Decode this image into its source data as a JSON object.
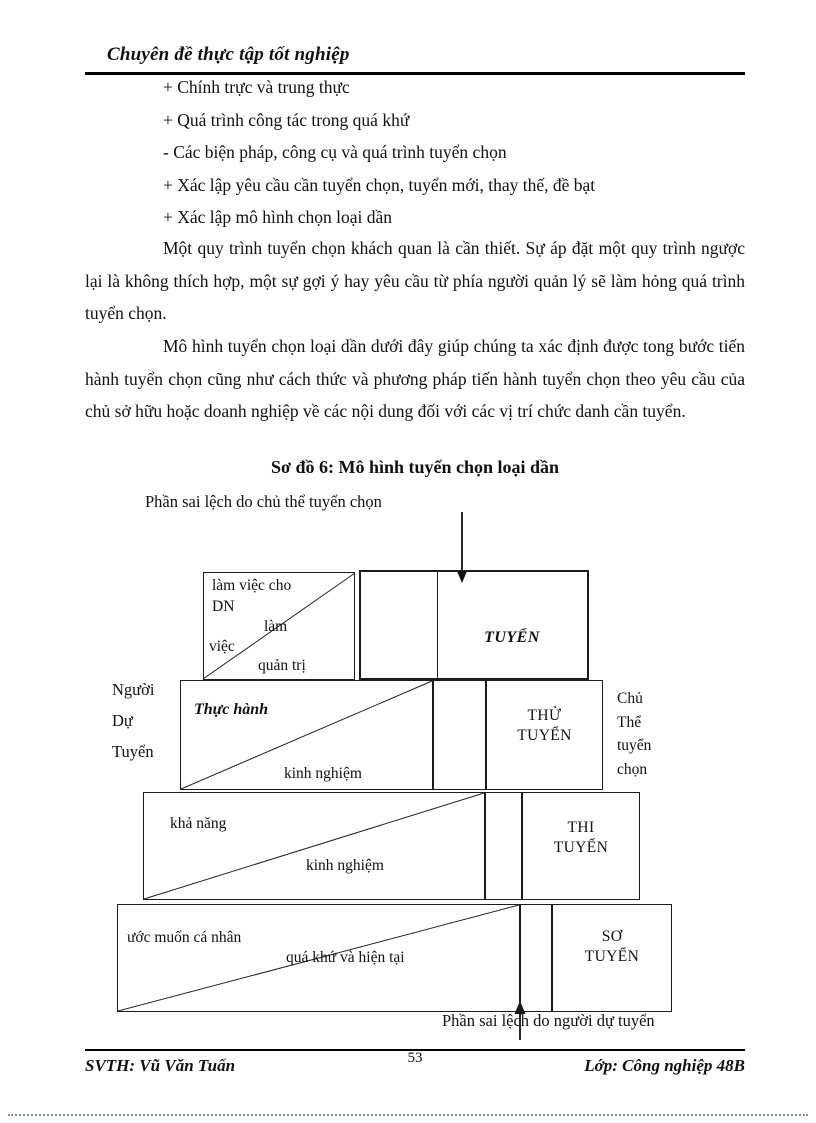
{
  "header": {
    "title": "Chuyên đề thực tập tốt nghiệp"
  },
  "bullets": [
    "+ Chính trực và trung thực",
    "+ Quá trình công tác trong quá khứ",
    "- Các biện pháp, công cụ và quá trình tuyển chọn",
    "+ Xác lập yêu cầu cần tuyển chọn, tuyển mới, thay thế, đề bạt",
    "+ Xác lập mô hình chọn loại dần"
  ],
  "paragraphs": [
    "Một quy trình tuyển chọn khách quan là cần thiết.  Sự áp đặt một quy trình ngược lại  là không thích hợp, một sự gợi ý hay yêu cầu từ phía người quản lý  sẽ làm hỏng quá trình tuyển chọn.",
    "Mô hình tuyển chọn loại dần dưới đây giúp  chúng ta xác định được tong bước tiến hành tuyển chọn cũng như cách thức và phương pháp tiến hành tuyển chọn theo yêu  cầu của chủ sở hữu hoặc doanh nghiệp về các nội dung đối với các vị trí chức danh cần tuyển."
  ],
  "diagram": {
    "title": "Sơ đồ 6: Mô hình tuyển chọn loại dần",
    "top_caption": "Phần sai lệch do chủ thể tuyển chọn",
    "bottom_caption": "Phần sai lệch do người dự tuyển",
    "left_label": [
      "Người",
      "Dự",
      "Tuyển"
    ],
    "right_label": [
      "Chủ",
      "Thể",
      "tuyển",
      "chọn"
    ],
    "row1": {
      "t1": "làm việc cho",
      "t2": "DN",
      "t3": "làm",
      "t4": "việc",
      "t5": "quản trị",
      "stage": "TUYỂN"
    },
    "row2": {
      "skill": "Thực hành",
      "exp": "kinh nghiệm",
      "stage1": "THỬ",
      "stage2": "TUYỂN"
    },
    "row3": {
      "skill": "khả năng",
      "exp": "kinh nghiệm",
      "stage1": "THI",
      "stage2": "TUYỂN"
    },
    "row4": {
      "skill": "ước muốn cá nhân",
      "exp": "quá khứ và hiện tại",
      "stage1": "SƠ",
      "stage2": "TUYỂN"
    }
  },
  "footer": {
    "left": "SVTH:  Vũ Văn Tuấn",
    "page": "53",
    "right": "Lớp: Công nghiệp 48B"
  }
}
